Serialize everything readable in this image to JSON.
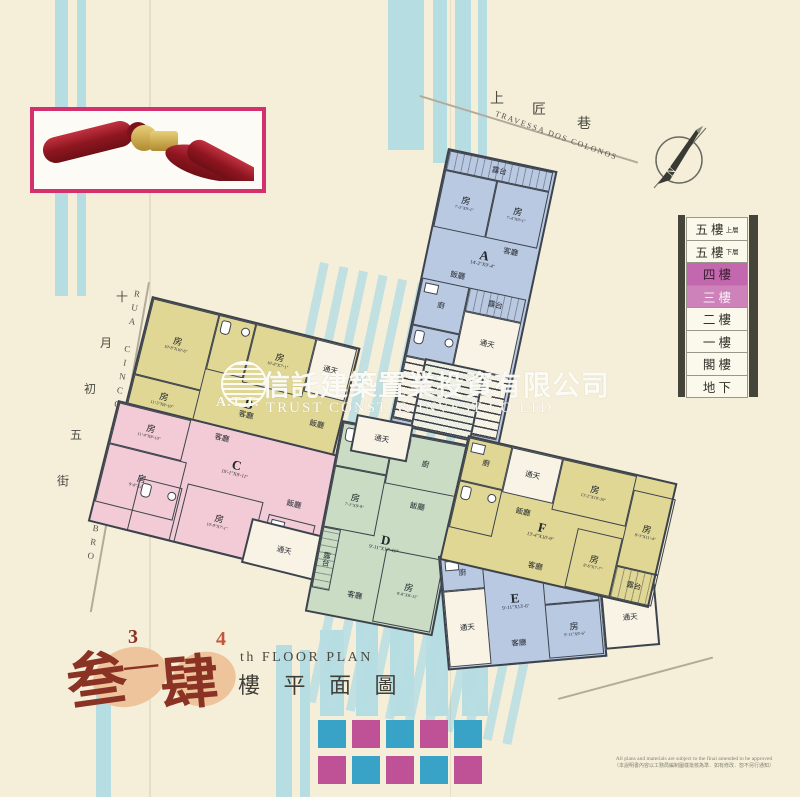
{
  "streets": {
    "top_zh": [
      "上",
      "匠",
      "巷"
    ],
    "top_pt": "TRAVESSA  DOS  COLONOS",
    "left_pt": "RUA CINCO DE OUTUBRO",
    "left_zh": [
      "十",
      "月",
      "初",
      "五",
      "街"
    ]
  },
  "legend": {
    "rows": [
      {
        "label": "五 樓",
        "sub": "上層"
      },
      {
        "label": "五 樓",
        "sub": "下層"
      },
      {
        "label": "四 樓",
        "sub": ""
      },
      {
        "label": "三 樓",
        "sub": ""
      },
      {
        "label": "二 樓",
        "sub": ""
      },
      {
        "label": "一 樓",
        "sub": ""
      },
      {
        "label": "閣 樓",
        "sub": ""
      },
      {
        "label": "地 下",
        "sub": ""
      }
    ]
  },
  "compass": {
    "n": "N"
  },
  "watermark": {
    "logo_text": "A.T.T.",
    "zh": "信託建築置業投資有限公司",
    "en": "TRUST  CONST.  &  INVEST  CO.LTD."
  },
  "labels": {
    "room": "房",
    "living": "客廳",
    "dining": "飯廳",
    "kitchen": "廚",
    "balcony": "露台",
    "lightwell": "通天"
  },
  "units": {
    "A": {
      "letter": "A",
      "dim": "14'-2\"X9'-4\"",
      "room1_dim": "7'-3\"X9'-1\"",
      "room2_dim": "7'-4\"X9'-1\""
    },
    "B": {
      "letter": "B",
      "room1_dim": "10'-8\"X10'-6\"",
      "room2_dim": "10'-8\"X7'-1\"",
      "room3_dim": "11'-5\"X8'-10\""
    },
    "C": {
      "letter": "C",
      "dim": "19'-1\"X9'-11\"",
      "room1_dim": "11'-4\"X8'-10\"",
      "room2_dim": "9'-8\"X10'-6\"",
      "room3_dim": "10'-9\"X7'-1\""
    },
    "D": {
      "letter": "D",
      "dim": "9'-11\"X17'-10\"",
      "room1_dim": "7'-1\"X9'-9\"",
      "room2_dim": "8'-8\"X8'-11\""
    },
    "E": {
      "letter": "E",
      "dim": "9'-11\"X13'-6\"",
      "room1_dim": "9'-11\"X9'-7\"",
      "room2_dim": "9'-11\"X9'-6\""
    },
    "F": {
      "letter": "F",
      "dim": "13'-4\"X10'-9\"",
      "room1_dim": "13'-2\"X10'-10\"",
      "room2_dim": "8'-3\"X11'-4\"",
      "room3_dim": "8'-6\"X7'-7\""
    }
  },
  "title": {
    "big1": "叁",
    "sup1": "3",
    "dash": "—",
    "big2": "肆",
    "sup2": "4",
    "en": "th  FLOOR  PLAN",
    "zh": "樓 平 面 圖"
  },
  "footnote": {
    "en": "All plans and materials are subject to the final amended to be approved",
    "zh": "（本說明書內容以工務局編制圖樣批核為準．如有修改．恕不另行通知）"
  },
  "colors": {
    "paper": "#f5efda",
    "teal_stripe": "#b5dde2",
    "unit_blue": "#bac9e2",
    "unit_yellow": "#e0d795",
    "unit_pink": "#f2cbd6",
    "unit_green": "#cadcc4",
    "wall": "#3d434c",
    "legend_hl": "#c368ae",
    "frame_magenta": "#d5306e",
    "square_teal": "#39a2c7",
    "square_magenta": "#bf5197",
    "title_red": "#8a3324"
  }
}
